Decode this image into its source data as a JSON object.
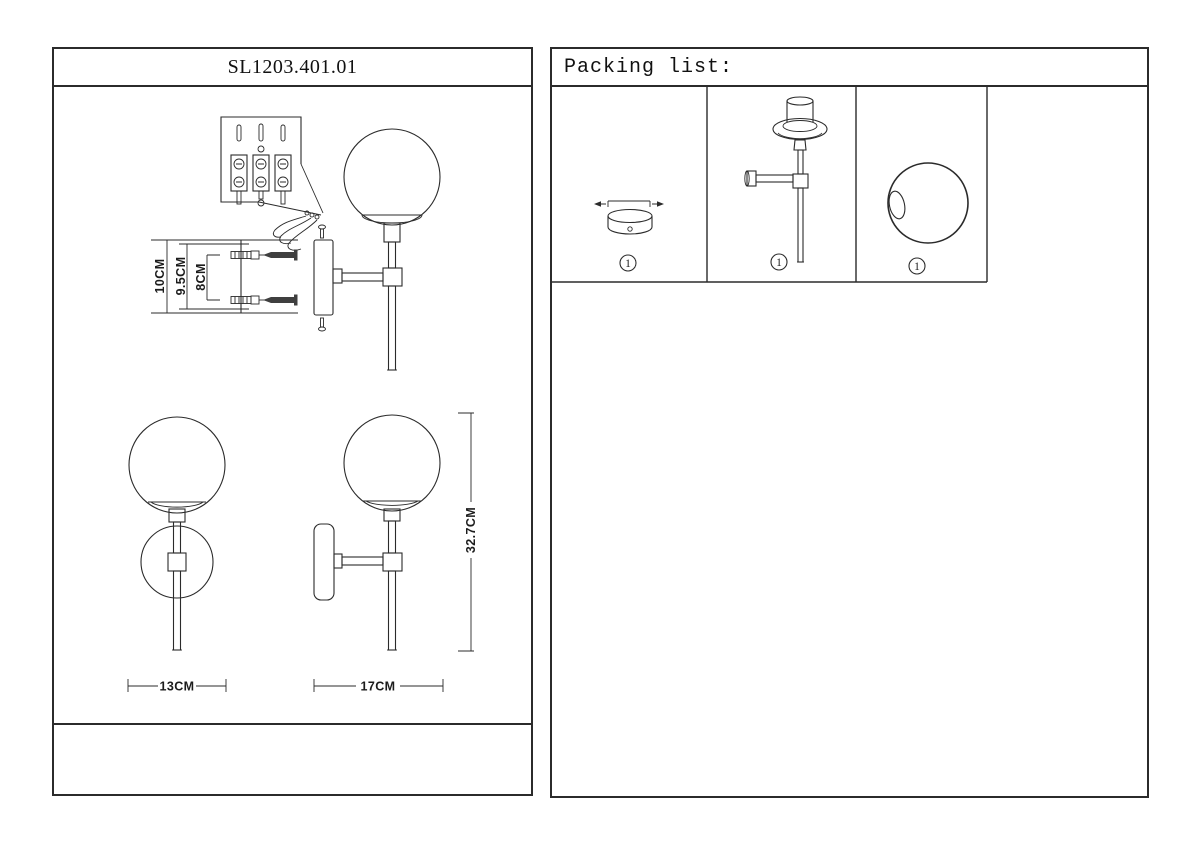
{
  "colors": {
    "line": "#2b2b2b",
    "background": "#ffffff"
  },
  "left_panel": {
    "title": "SL1203.401.01",
    "installation_diagram": {
      "dim_total_height": "10CM",
      "dim_plate_height": "9.5CM",
      "dim_hole_spacing": "8CM"
    },
    "front_view": {
      "dim_width": "13CM"
    },
    "side_view": {
      "dim_depth": "17CM",
      "dim_height": "32.7CM"
    }
  },
  "right_panel": {
    "title": "Packing list:",
    "items": [
      {
        "icon": "canopy-base-icon",
        "qty": "1"
      },
      {
        "icon": "lamp-body-icon",
        "qty": "1"
      },
      {
        "icon": "glass-globe-icon",
        "qty": "1"
      }
    ]
  }
}
